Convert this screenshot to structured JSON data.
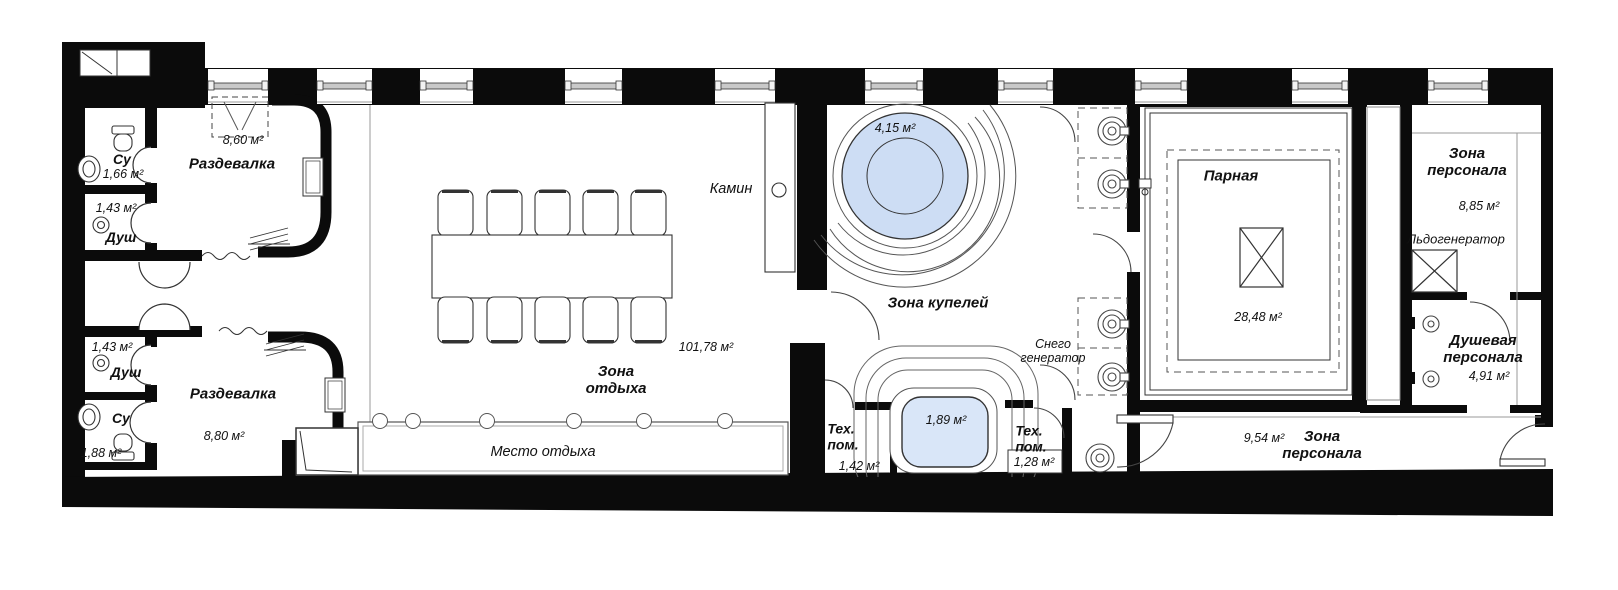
{
  "theme": {
    "wall_color": "#0b0b0b",
    "line_color": "#333333",
    "pool_fill": "#cdddf4",
    "tub_fill": "#d9e6f8",
    "paper": "#ffffff"
  },
  "labels": {
    "su_top": "Су",
    "su_top_area": "1,66 м²",
    "razdevalka_top": "Раздевалка",
    "razdevalka_top_area": "8,60 м²",
    "dush_top_area": "1,43 м²",
    "dush_top": "Душ",
    "dush_bot_area": "1,43 м²",
    "dush_bot": "Душ",
    "su_bot": "Су",
    "su_bot_area": "1,88 м²",
    "razdevalka_bot": "Раздевалка",
    "razdevalka_bot_area": "8,80 м²",
    "zona_otdyha": "Зона\nотдыха",
    "zona_otdyha_area": "101,78 м²",
    "mesto_otdyha": "Место отдыха",
    "kamin": "Камин",
    "pool_area": "4,15 м²",
    "zona_kupelei": "Зона купелей",
    "tub_area": "1,89 м²",
    "teh_pom_left": "Тех.\nпом.",
    "teh_pom_left_area": "1,42 м²",
    "teh_pom_right": "Тех.\nпом.",
    "teh_pom_right_area": "1,28 м²",
    "snego": "Снего\nгенератор",
    "parnaya": "Парная",
    "parnaya_area": "28,48 м²",
    "zona_personala_top": "Зона\nперсонала",
    "zona_personala_top_area": "8,85 м²",
    "ldogenerator": "Льдогенератор",
    "dushevaya": "Душевая\nперсонала",
    "dushevaya_area": "4,91 м²",
    "corridor_area": "9,54 м²",
    "zona_personala_bot": "Зона\nперсонала"
  }
}
